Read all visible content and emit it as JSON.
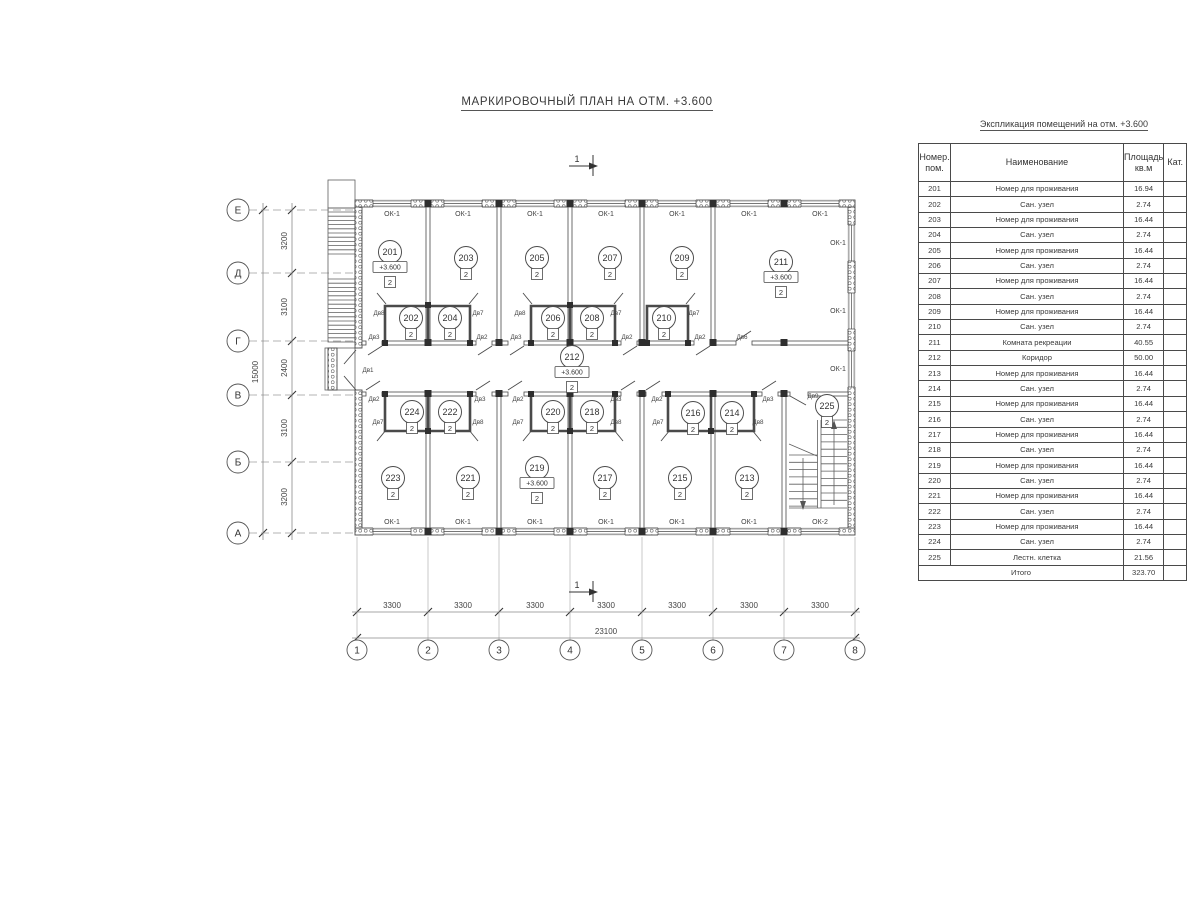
{
  "title": "МАРКИРОВОЧНЫЙ ПЛАН НА ОТМ. +3.600",
  "explication": {
    "title": "Экспликация помещений на отм. +3.600",
    "col_num_1": "Номер.",
    "col_num_2": "пом.",
    "col_name": "Наименование",
    "col_area_1": "Площадь",
    "col_area_2": "кв.м",
    "col_cat": "Кат.",
    "rows": [
      {
        "num": "201",
        "name": "Номер для проживания",
        "area": "16.94",
        "cat": ""
      },
      {
        "num": "202",
        "name": "Сан. узел",
        "area": "2.74",
        "cat": ""
      },
      {
        "num": "203",
        "name": "Номер для проживания",
        "area": "16.44",
        "cat": ""
      },
      {
        "num": "204",
        "name": "Сан. узел",
        "area": "2.74",
        "cat": ""
      },
      {
        "num": "205",
        "name": "Номер для проживания",
        "area": "16.44",
        "cat": ""
      },
      {
        "num": "206",
        "name": "Сан. узел",
        "area": "2.74",
        "cat": ""
      },
      {
        "num": "207",
        "name": "Номер для проживания",
        "area": "16.44",
        "cat": ""
      },
      {
        "num": "208",
        "name": "Сан. узел",
        "area": "2.74",
        "cat": ""
      },
      {
        "num": "209",
        "name": "Номер для проживания",
        "area": "16.44",
        "cat": ""
      },
      {
        "num": "210",
        "name": "Сан. узел",
        "area": "2.74",
        "cat": ""
      },
      {
        "num": "211",
        "name": "Комната рекреации",
        "area": "40.55",
        "cat": ""
      },
      {
        "num": "212",
        "name": "Коридор",
        "area": "50.00",
        "cat": ""
      },
      {
        "num": "213",
        "name": "Номер для проживания",
        "area": "16.44",
        "cat": ""
      },
      {
        "num": "214",
        "name": "Сан. узел",
        "area": "2.74",
        "cat": ""
      },
      {
        "num": "215",
        "name": "Номер для проживания",
        "area": "16.44",
        "cat": ""
      },
      {
        "num": "216",
        "name": "Сан. узел",
        "area": "2.74",
        "cat": ""
      },
      {
        "num": "217",
        "name": "Номер для проживания",
        "area": "16.44",
        "cat": ""
      },
      {
        "num": "218",
        "name": "Сан. узел",
        "area": "2.74",
        "cat": ""
      },
      {
        "num": "219",
        "name": "Номер для проживания",
        "area": "16.44",
        "cat": ""
      },
      {
        "num": "220",
        "name": "Сан. узел",
        "area": "2.74",
        "cat": ""
      },
      {
        "num": "221",
        "name": "Номер для проживания",
        "area": "16.44",
        "cat": ""
      },
      {
        "num": "222",
        "name": "Сан. узел",
        "area": "2.74",
        "cat": ""
      },
      {
        "num": "223",
        "name": "Номер для проживания",
        "area": "16.44",
        "cat": ""
      },
      {
        "num": "224",
        "name": "Сан. узел",
        "area": "2.74",
        "cat": ""
      },
      {
        "num": "225",
        "name": "Лестн. клетка",
        "area": "21.56",
        "cat": ""
      }
    ],
    "total_label": "Итого",
    "total_area": "323.70"
  },
  "plan": {
    "section_mark": "1",
    "cat_mark": "2",
    "axis_rows": [
      {
        "label": "Е",
        "y": 210
      },
      {
        "label": "Д",
        "y": 273
      },
      {
        "label": "Г",
        "y": 341
      },
      {
        "label": "В",
        "y": 395
      },
      {
        "label": "Б",
        "y": 462
      },
      {
        "label": "А",
        "y": 533
      }
    ],
    "axis_cols": [
      {
        "label": "1",
        "x": 357
      },
      {
        "label": "2",
        "x": 428
      },
      {
        "label": "3",
        "x": 499
      },
      {
        "label": "4",
        "x": 570
      },
      {
        "label": "5",
        "x": 642
      },
      {
        "label": "6",
        "x": 713
      },
      {
        "label": "7",
        "x": 784
      },
      {
        "label": "8",
        "x": 855
      }
    ],
    "v_dims": [
      {
        "label": "3200",
        "y": 241
      },
      {
        "label": "3100",
        "y": 307
      },
      {
        "label": "2400",
        "y": 368
      },
      {
        "label": "3100",
        "y": 428
      },
      {
        "label": "3200",
        "y": 497
      }
    ],
    "v_total": {
      "label": "15000",
      "y": 372
    },
    "h_dims": [
      {
        "label": "3300",
        "x": 392
      },
      {
        "label": "3300",
        "x": 463
      },
      {
        "label": "3300",
        "x": 535
      },
      {
        "label": "3300",
        "x": 606
      },
      {
        "label": "3300",
        "x": 677
      },
      {
        "label": "3300",
        "x": 749
      },
      {
        "label": "3300",
        "x": 820
      }
    ],
    "h_total": {
      "label": "23100",
      "x": 606
    },
    "rooms": [
      {
        "num": "201",
        "x": 390,
        "y": 252,
        "elev": "+3.600"
      },
      {
        "num": "202",
        "x": 411,
        "y": 318
      },
      {
        "num": "203",
        "x": 466,
        "y": 258
      },
      {
        "num": "204",
        "x": 450,
        "y": 318
      },
      {
        "num": "205",
        "x": 537,
        "y": 258
      },
      {
        "num": "206",
        "x": 553,
        "y": 318
      },
      {
        "num": "207",
        "x": 610,
        "y": 258
      },
      {
        "num": "208",
        "x": 592,
        "y": 318
      },
      {
        "num": "209",
        "x": 682,
        "y": 258
      },
      {
        "num": "210",
        "x": 664,
        "y": 318
      },
      {
        "num": "211",
        "x": 781,
        "y": 262,
        "elev": "+3.600"
      },
      {
        "num": "212",
        "x": 572,
        "y": 357,
        "elev": "+3.600"
      },
      {
        "num": "213",
        "x": 747,
        "y": 478
      },
      {
        "num": "214",
        "x": 732,
        "y": 413
      },
      {
        "num": "215",
        "x": 680,
        "y": 478
      },
      {
        "num": "216",
        "x": 693,
        "y": 413
      },
      {
        "num": "217",
        "x": 605,
        "y": 478
      },
      {
        "num": "218",
        "x": 592,
        "y": 412
      },
      {
        "num": "219",
        "x": 537,
        "y": 468,
        "elev": "+3.600"
      },
      {
        "num": "220",
        "x": 553,
        "y": 412
      },
      {
        "num": "221",
        "x": 468,
        "y": 478
      },
      {
        "num": "222",
        "x": 450,
        "y": 412
      },
      {
        "num": "223",
        "x": 393,
        "y": 478
      },
      {
        "num": "224",
        "x": 412,
        "y": 412
      },
      {
        "num": "225",
        "x": 827,
        "y": 406
      }
    ],
    "door_labels": [
      {
        "t": "Дв8",
        "x": 379,
        "y": 315
      },
      {
        "t": "Дв7",
        "x": 478,
        "y": 315
      },
      {
        "t": "Дв8",
        "x": 520,
        "y": 315
      },
      {
        "t": "Дв7",
        "x": 616,
        "y": 315
      },
      {
        "t": "Дв7",
        "x": 694,
        "y": 315
      },
      {
        "t": "Дв3",
        "x": 374,
        "y": 339
      },
      {
        "t": "Дв2",
        "x": 482,
        "y": 339
      },
      {
        "t": "Дв3",
        "x": 516,
        "y": 339
      },
      {
        "t": "Дв2",
        "x": 627,
        "y": 339
      },
      {
        "t": "Дв2",
        "x": 700,
        "y": 339
      },
      {
        "t": "Дв6",
        "x": 742,
        "y": 339
      },
      {
        "t": "Дв1",
        "x": 368,
        "y": 372
      },
      {
        "t": "Дв2",
        "x": 374,
        "y": 401
      },
      {
        "t": "Дв3",
        "x": 480,
        "y": 401
      },
      {
        "t": "Дв2",
        "x": 518,
        "y": 401
      },
      {
        "t": "Дв3",
        "x": 616,
        "y": 401
      },
      {
        "t": "Дв2",
        "x": 657,
        "y": 401
      },
      {
        "t": "Дв3",
        "x": 768,
        "y": 401
      },
      {
        "t": "Дв9",
        "x": 813,
        "y": 398
      },
      {
        "t": "Дв7",
        "x": 378,
        "y": 424
      },
      {
        "t": "Дв8",
        "x": 478,
        "y": 424
      },
      {
        "t": "Дв7",
        "x": 518,
        "y": 424
      },
      {
        "t": "Дв8",
        "x": 616,
        "y": 424
      },
      {
        "t": "Дв7",
        "x": 658,
        "y": 424
      },
      {
        "t": "Дв8",
        "x": 758,
        "y": 424
      }
    ],
    "window_labels": [
      {
        "t": "ОК-1",
        "wall": "top",
        "x": 392
      },
      {
        "t": "ОК-1",
        "wall": "top",
        "x": 463
      },
      {
        "t": "ОК-1",
        "wall": "top",
        "x": 535
      },
      {
        "t": "ОК-1",
        "wall": "top",
        "x": 606
      },
      {
        "t": "ОК-1",
        "wall": "top",
        "x": 677
      },
      {
        "t": "ОК-1",
        "wall": "top",
        "x": 749
      },
      {
        "t": "ОК-1",
        "wall": "top",
        "x": 820
      },
      {
        "t": "ОК-1",
        "wall": "right",
        "y": 243
      },
      {
        "t": "ОК-1",
        "wall": "right",
        "y": 311
      },
      {
        "t": "ОК-1",
        "wall": "right",
        "y": 369
      },
      {
        "t": "ОК-1",
        "wall": "bottom",
        "x": 392
      },
      {
        "t": "ОК-1",
        "wall": "bottom",
        "x": 463
      },
      {
        "t": "ОК-1",
        "wall": "bottom",
        "x": 535
      },
      {
        "t": "ОК-1",
        "wall": "bottom",
        "x": 606
      },
      {
        "t": "ОК-1",
        "wall": "bottom",
        "x": 677
      },
      {
        "t": "ОК-1",
        "wall": "bottom",
        "x": 749
      },
      {
        "t": "ОК-2",
        "wall": "bottom",
        "x": 820
      }
    ]
  }
}
